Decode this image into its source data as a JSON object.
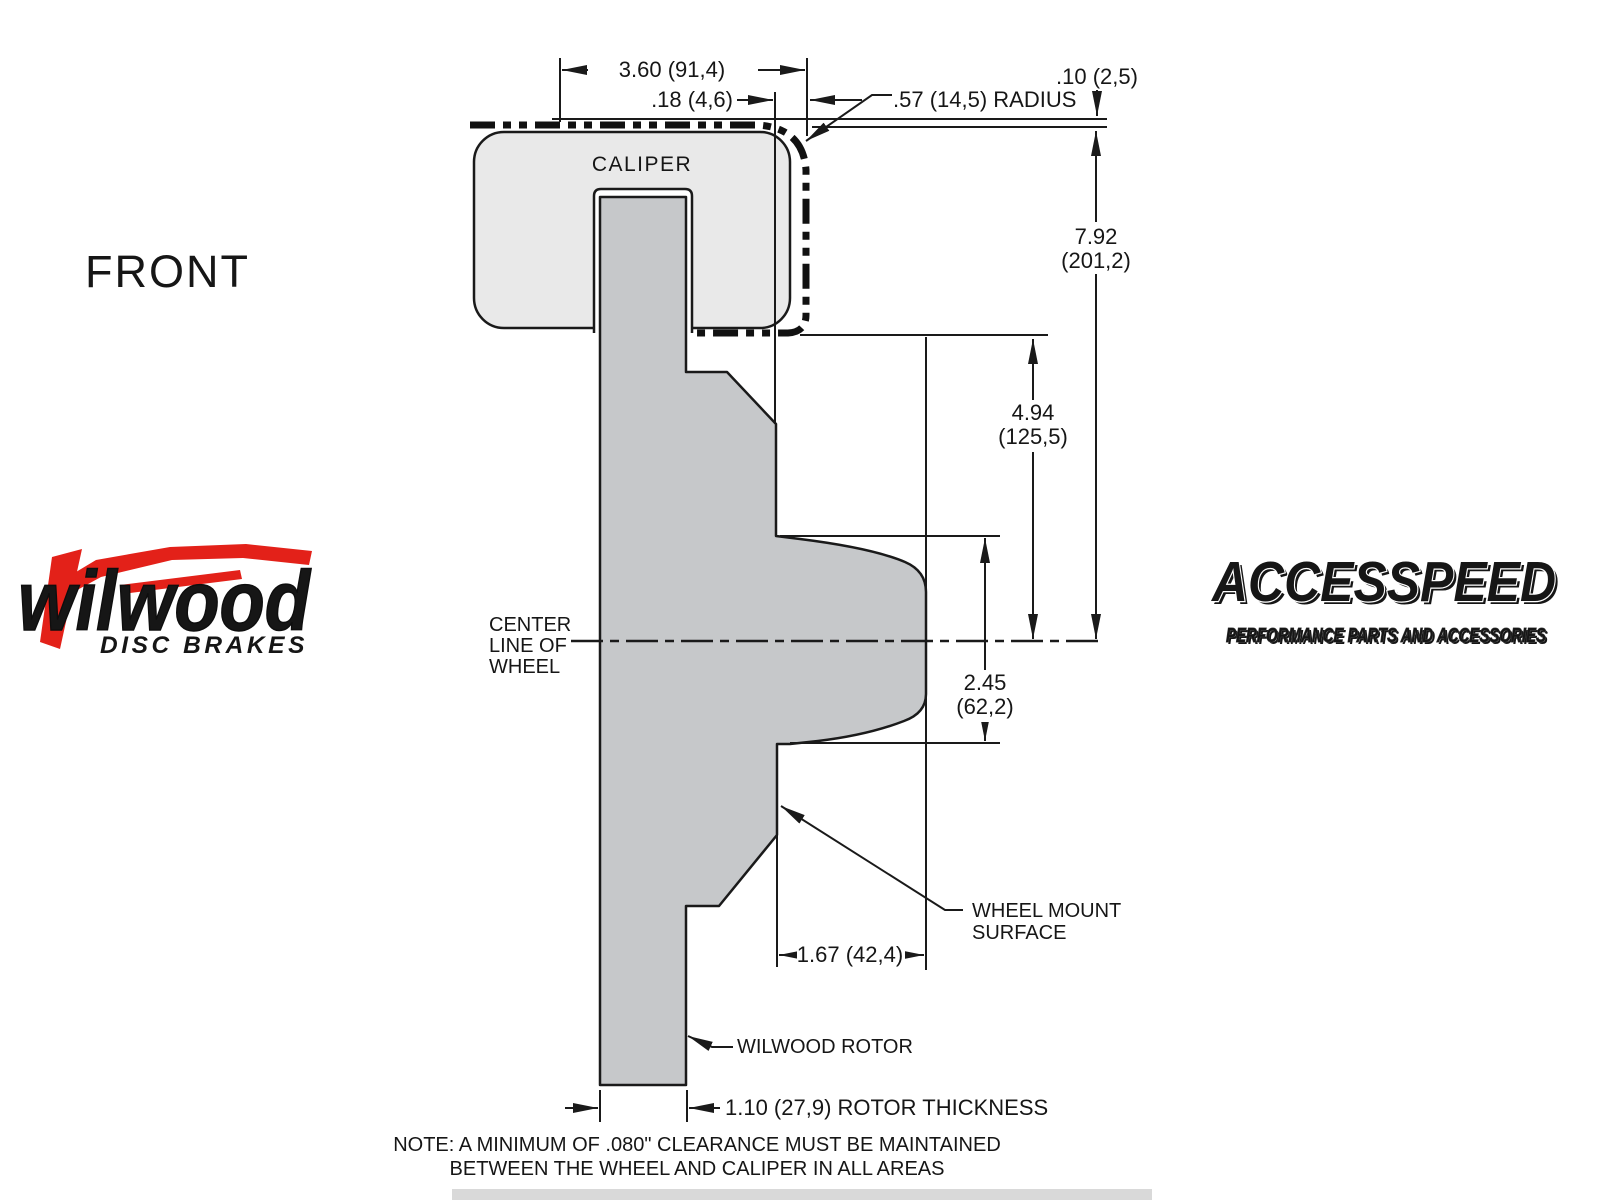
{
  "front_label": "FRONT",
  "logos": {
    "wilwood": {
      "name": "wilwood",
      "tagline": "DISC BRAKES"
    },
    "accesspeed": {
      "name": "ACCESSPEED",
      "tagline": "PERFORMANCE PARTS AND ACCESSORIES"
    }
  },
  "diagram": {
    "caliper_label": "CALIPER",
    "centerline": {
      "line1": "CENTER",
      "line2": "LINE OF",
      "line3": "WHEEL"
    },
    "dimensions": {
      "caliper_width": "3.60 (91,4)",
      "pad_offset": ".18 (4,6)",
      "corner_radius": ".57 (14,5) RADIUS",
      "wheel_clearance": ".10 (2,5)",
      "wheel_to_centerline": {
        "value": "7.92",
        "metric": "(201,2)"
      },
      "caliper_to_centerline": {
        "value": "4.94",
        "metric": "(125,5)"
      },
      "hat_depth": {
        "value": "2.45",
        "metric": "(62,2)"
      },
      "mount_depth": "1.67 (42,4)",
      "rotor_thickness": "1.10 (27,9) ROTOR THICKNESS"
    },
    "callouts": {
      "wheel_mount_line1": "WHEEL MOUNT",
      "wheel_mount_line2": "SURFACE",
      "rotor": "WILWOOD ROTOR"
    },
    "note_line1": "NOTE: A MINIMUM OF .080\" CLEARANCE MUST BE MAINTAINED",
    "note_line2": "BETWEEN THE WHEEL AND CALIPER IN ALL AREAS"
  },
  "colors": {
    "wilwood_red": "#e32119",
    "caliper_fill": "#e9e9e9",
    "rotor_fill": "#c6c8ca",
    "line_color": "#1a1a1a"
  }
}
